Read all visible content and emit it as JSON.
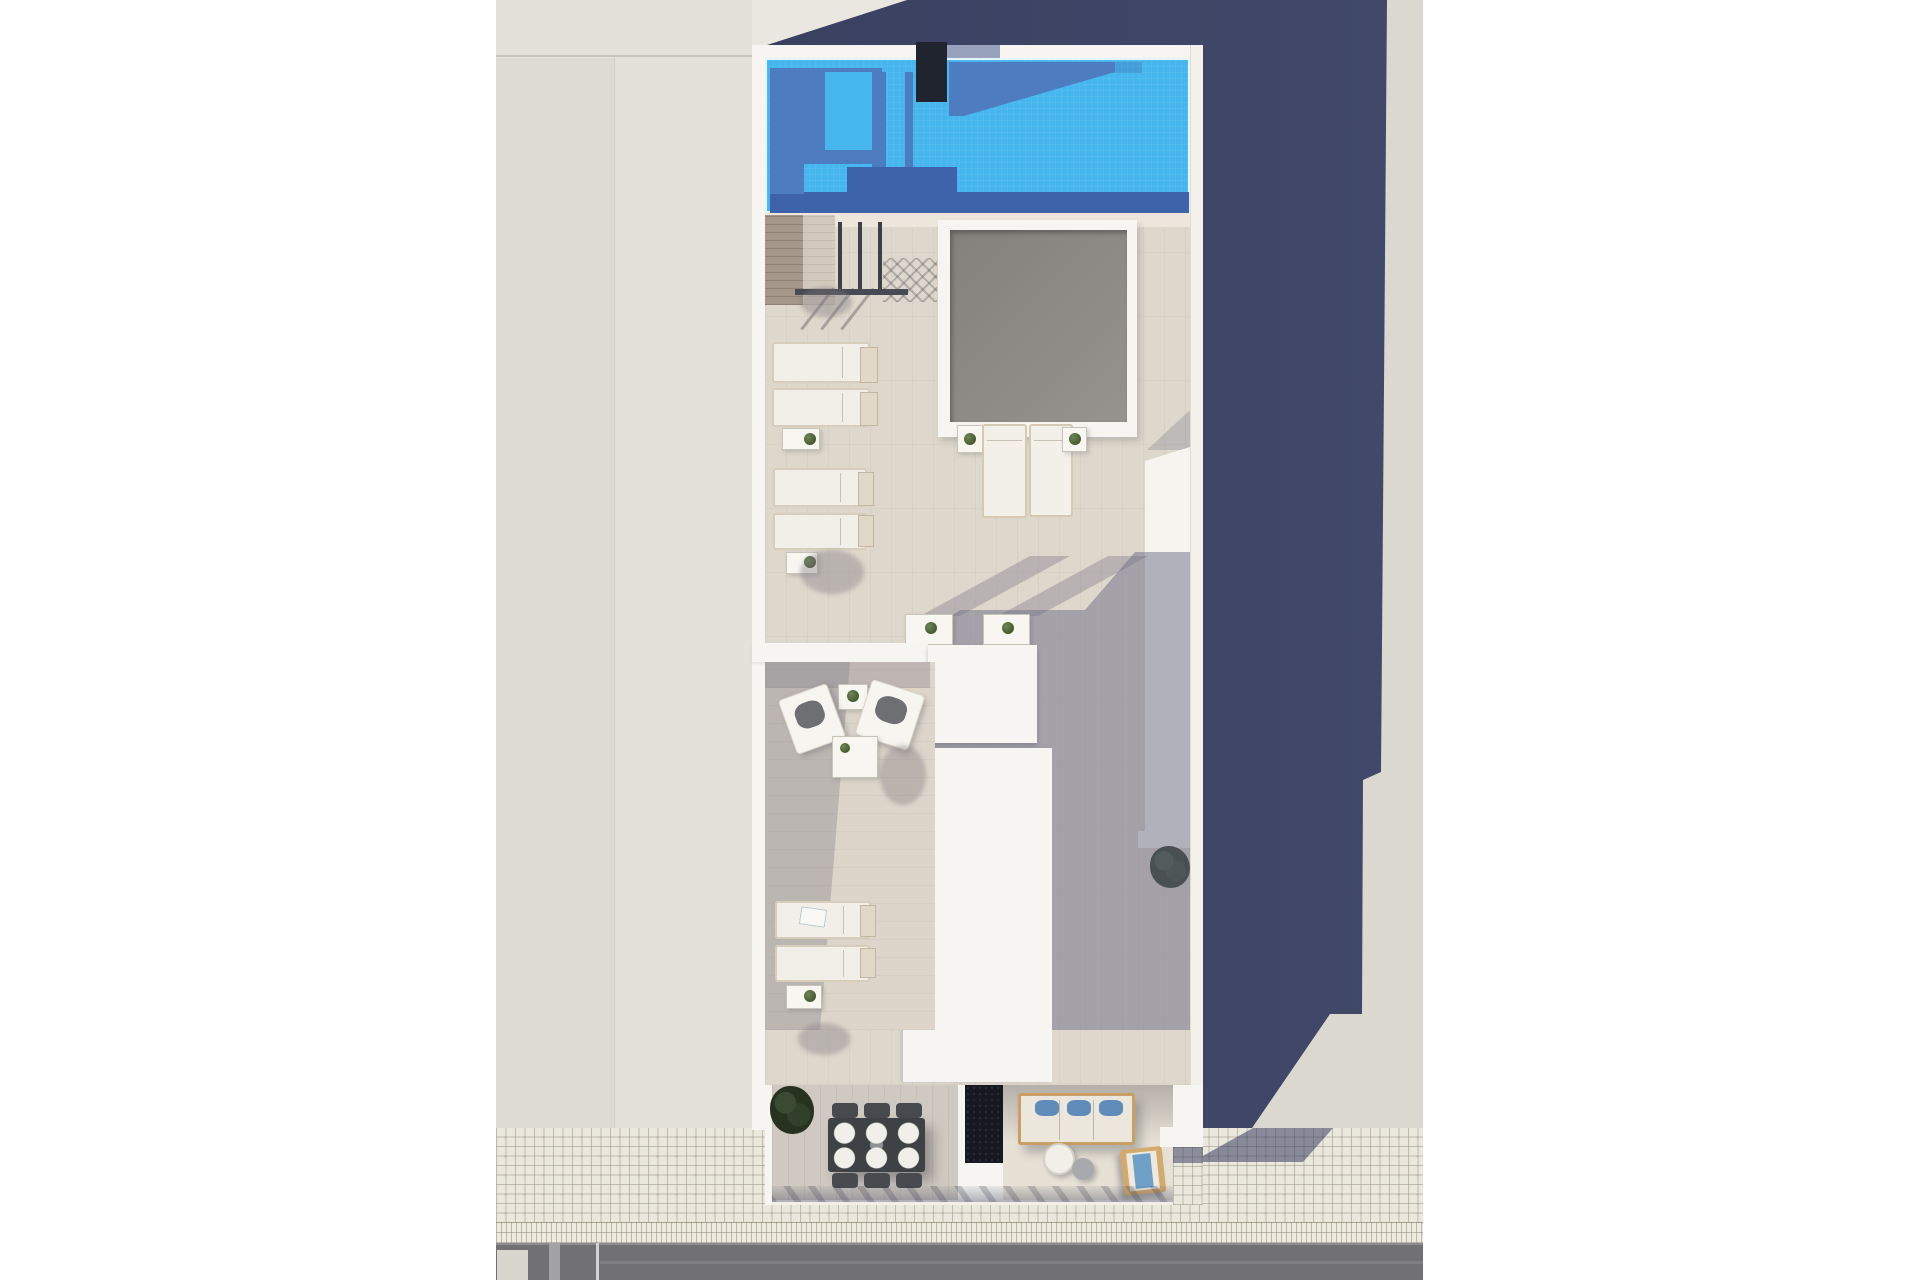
{
  "scene": {
    "kind": "architectural-3d-render",
    "view": "top-down aerial of a rooftop terrace floor plan with street below",
    "inventory": {
      "swimming_pool": 1,
      "rooftop_skylight": 1,
      "sun_loungers_horizontal_pairs": 3,
      "sun_loungers_vertical_pair": 1,
      "armchairs": 2,
      "coffee_tables": 1,
      "side_tables": 6,
      "bistro_tables": 2,
      "dining_table_seats": 6,
      "outdoor_sofa": 1,
      "round_tables": 2,
      "wooden_lounger": 1,
      "planter_bench": 1,
      "bushes": 12,
      "stair_access": 1,
      "chimney_block": 1
    }
  },
  "palette": {
    "bg": "#ffffff",
    "facade": "#e4e1d9",
    "facade-top": "#eae7e0",
    "ground-right": "#dbd8cf",
    "shadow": "#414869",
    "shadow-dark": "#3a4060",
    "building": "#f7f5f1",
    "deck": "#ded7cb",
    "pool": "#45b6ee",
    "pool-mid": "#4d7dc0",
    "pool-deep": "#3f63ab",
    "chimney": "#20242f",
    "skylight": "#8e8b87",
    "tile": "#eae7dd",
    "tile-border": "#edebe0",
    "road": "#717074",
    "green": "#3c4f30",
    "wood": "#d3a96d",
    "pillow-blue": "#5f8cb8"
  }
}
